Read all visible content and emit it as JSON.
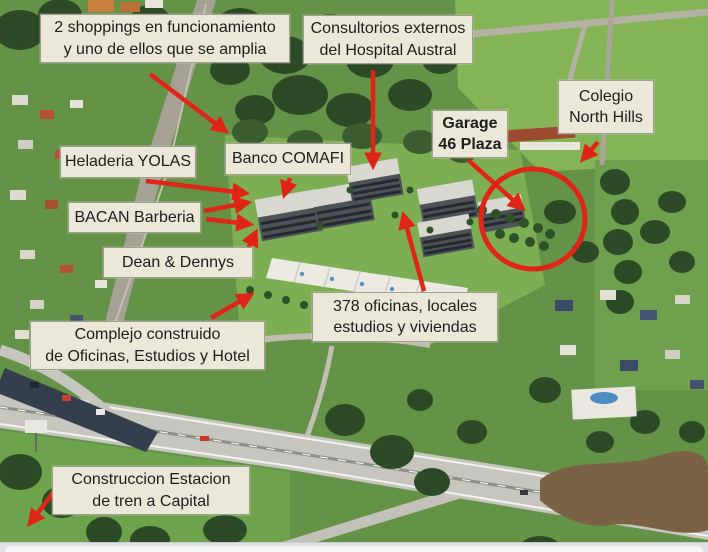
{
  "annotations": {
    "shoppings": {
      "line1": "2 shoppings en funcionamiento",
      "line2": "y uno de ellos que se amplia"
    },
    "consultorios": {
      "line1": "Consultorios externos",
      "line2": "del Hospital Austral"
    },
    "colegio": {
      "line1": "Colegio",
      "line2": "North Hills"
    },
    "garage": {
      "line1": "Garage",
      "line2": "46 Plaza"
    },
    "heladeria": {
      "line1": "Heladeria YOLAS"
    },
    "banco": {
      "line1": "Banco COMAFI"
    },
    "bacan": {
      "line1": "BACAN Barberia"
    },
    "dean": {
      "line1": "Dean & Dennys"
    },
    "oficinas": {
      "line1": "378 oficinas, locales",
      "line2": "estudios y viviendas"
    },
    "complejo": {
      "line1": "Complejo construido",
      "line2": "de Oficinas, Estudios y Hotel"
    },
    "estacion": {
      "line1": "Construccion Estacion",
      "line2": "de tren a Capital"
    }
  },
  "colors": {
    "annotation_red": "#e02417",
    "label_background": "#ebe7d9",
    "label_text": "#1d1d1b",
    "grass_green": "#649347",
    "highlight_circle": "#e02417"
  }
}
